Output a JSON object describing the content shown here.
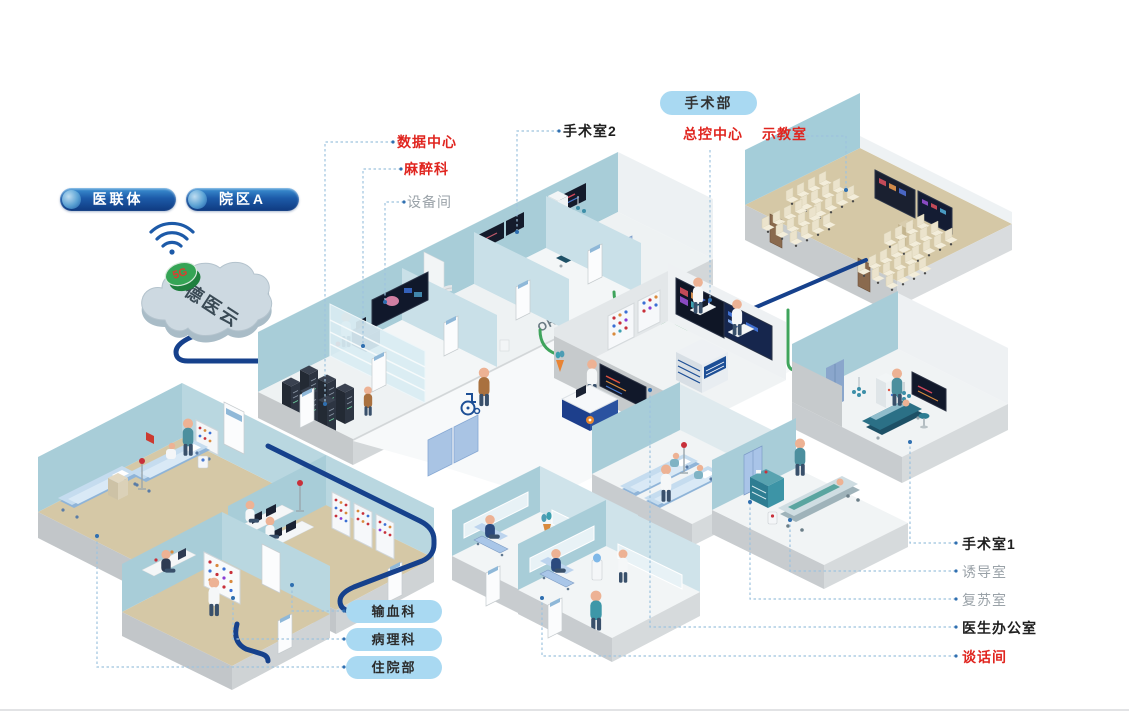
{
  "colors": {
    "label_red": "#e0251f",
    "label_gray": "#9aa2a8",
    "label_dark": "#1f1f1f",
    "pill_light_blue": "#a9d9f2",
    "pill_navy_dark": "#0f3a80",
    "pill_navy_light": "#3d92d4",
    "cable_navy": "#16418c",
    "cable_green": "#3fa45c",
    "wall_blue": "#a8cdd8",
    "floor_tan": "#d5c8a6"
  },
  "header": {
    "department_pill": "手术部"
  },
  "network": {
    "org_pill_1": "医联体",
    "org_pill_2": "院区A",
    "cloud_name": "德医云",
    "cloud_badge": "5G"
  },
  "rooms": {
    "data_center": "数据中心",
    "anesthesiology": "麻醉科",
    "equipment_room": "设备间",
    "operating_room_2": "手术室2",
    "master_control_center": "总控中心",
    "demo_classroom": "示教室",
    "blood_transfusion": "输血科",
    "pathology": "病理科",
    "inpatient_dept": "住院部",
    "operating_room_1": "手术室1",
    "induction_room": "诱导室",
    "recovery_room": "复苏室",
    "doctors_office": "医生办公室",
    "talk_room": "谈话间"
  },
  "room_tags": {
    "or2": "OR2",
    "or3": "OR3"
  }
}
